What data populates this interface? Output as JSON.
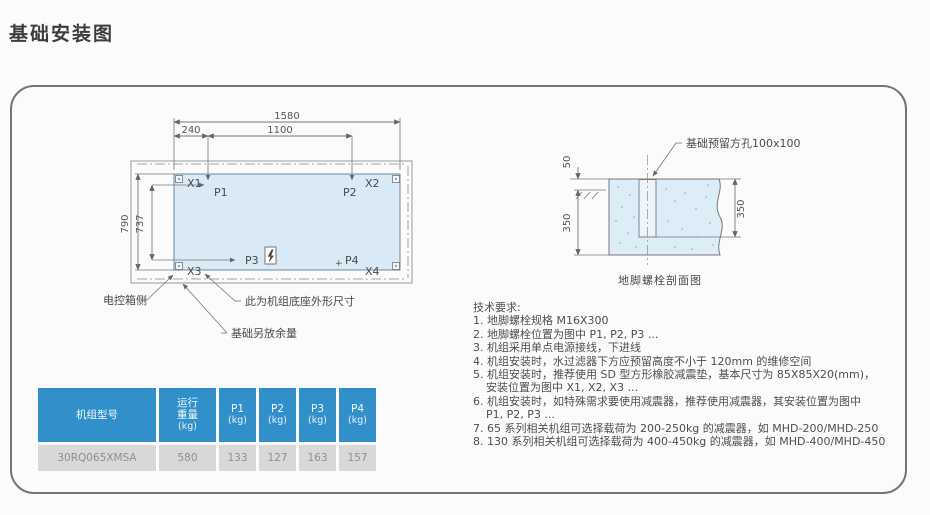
{
  "page": {
    "title": "基础安装图"
  },
  "plan": {
    "dims": {
      "total_width": "1580",
      "left_offset": "240",
      "mid_span": "1100",
      "outer_height": "790",
      "inner_height": "737"
    },
    "anchors": {
      "x1": "X1",
      "x2": "X2",
      "x3": "X3",
      "x4": "X4"
    },
    "points": {
      "p1": "P1",
      "p2": "P2",
      "p3": "P3",
      "p4": "P4",
      "p4_mark": "+"
    },
    "labels": {
      "control_box_side": "电控箱侧",
      "base_outline": "此为机组底座外形尺寸",
      "foundation_margin": "基础另放余量"
    }
  },
  "section": {
    "dims": {
      "above_ground": "50",
      "depth": "350",
      "slot_depth": "350"
    },
    "hole_label": "基础预留方孔100x100",
    "caption": "地脚螺栓剖面图"
  },
  "tech": {
    "title": "技术要求:",
    "lines": [
      "1. 地脚螺栓规格 M16X300",
      "2. 地脚螺栓位置为图中 P1, P2, P3 ...",
      "3. 机组采用单点电源接线，下进线",
      "4. 机组安装时，水过滤器下方应预留高度不小于 120mm 的维修空间",
      "5. 机组安装时，推荐使用 SD 型方形橡胶减震垫，基本尺寸为 85X85X20(mm)，",
      "安装位置为图中 X1, X2, X3 ...",
      "6. 机组安装时，如特殊需求要使用减震器，推荐使用减震器，其安装位置为图中",
      "P1, P2, P3 ...",
      "7. 65 系列相关机组可选择载荷为 200-250kg 的减震器，如 MHD-200/MHD-250",
      "8. 130 系列相关机组可选择载荷为 400-450kg 的减震器，如 MHD-400/MHD-450"
    ]
  },
  "table": {
    "columns": [
      {
        "label": "机组型号",
        "unit": ""
      },
      {
        "label": "运行重量",
        "unit": "(kg)"
      },
      {
        "label": "P1",
        "unit": "(kg)"
      },
      {
        "label": "P2",
        "unit": "(kg)"
      },
      {
        "label": "P3",
        "unit": "(kg)"
      },
      {
        "label": "P4",
        "unit": "(kg)"
      }
    ],
    "rows": [
      [
        "30RQ065XMSA",
        "580",
        "133",
        "127",
        "163",
        "157"
      ]
    ]
  },
  "colors": {
    "diagram_fill": "#d9eaf6",
    "table_header": "#3190ca",
    "table_row": "#d8d8d8",
    "line": "#777777"
  }
}
